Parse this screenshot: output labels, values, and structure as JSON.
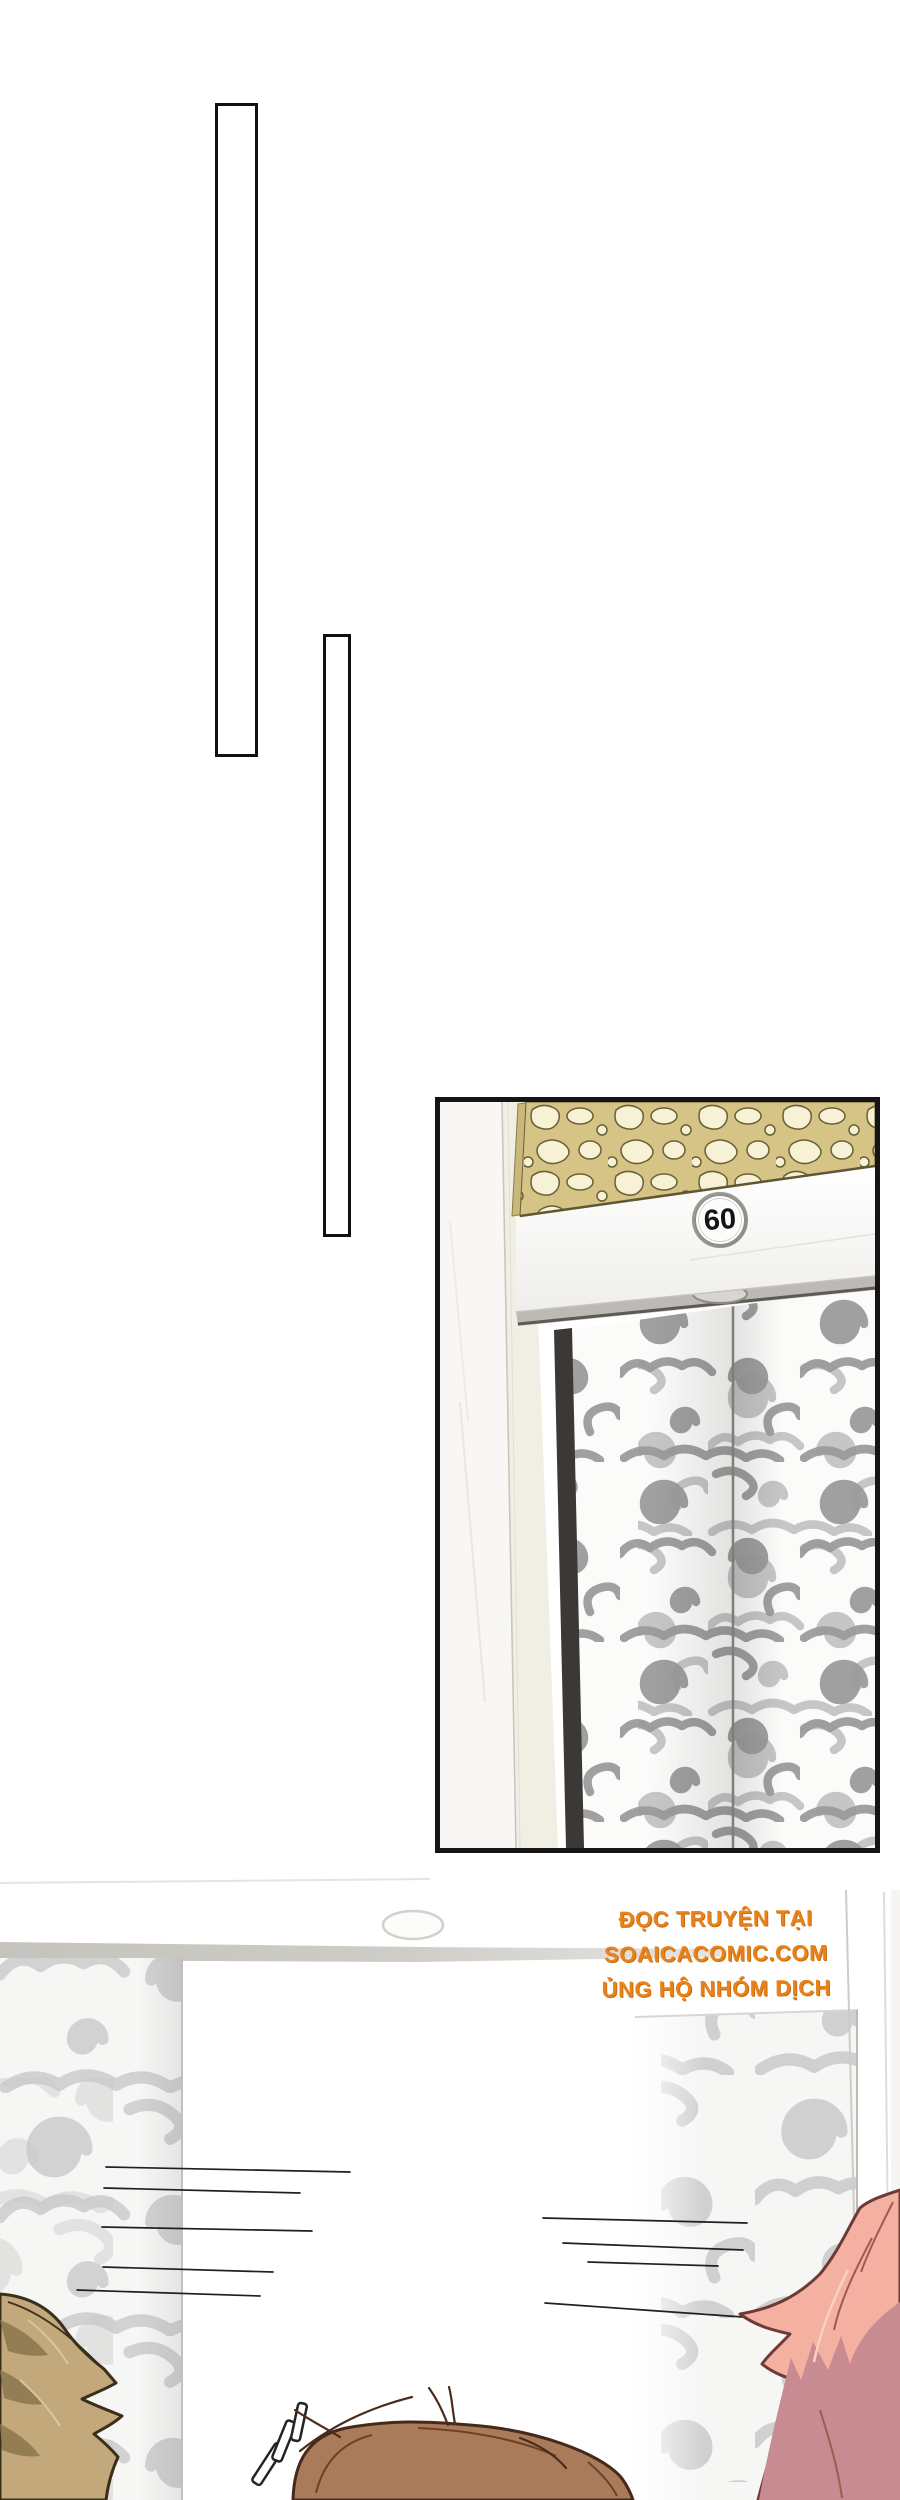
{
  "page": {
    "width": 900,
    "height": 2500,
    "background": "#ffffff",
    "kind": "comic-page"
  },
  "decor": {
    "bar_count": 2,
    "style": "thin outlined vertical rectangles"
  },
  "elevator_panel": {
    "floor_number": "60",
    "description": "framed panel: elevator entrance with golden openwork lattice transom, white header beam with round floor badge, gray cloud-swirl patterned doors"
  },
  "credits": {
    "line1": "ĐỌC TRUYỆN TẠI",
    "line2": "SOAICACOMIC.COM",
    "line3": "ỦNG HỘ NHÓM DỊCH",
    "color": "#e8821a"
  },
  "effects": {
    "exclamation_marks": "!!!",
    "speed_lines_left": 5,
    "speed_lines_right": 4
  },
  "colors": {
    "panel_border": "#151515",
    "lattice_gold": "#d6c486",
    "lattice_holes": "#f7f1d6",
    "lattice_outline": "#6a6036",
    "door_swirl_dark": "#9b9b9b",
    "door_swirl_light": "#c9c9c9",
    "beam_soffit": "#bdb9b4",
    "hair_left": "#c2a87a",
    "hair_left_shadow": "#8e7950",
    "hair_center": "#a97b5b",
    "hair_right_light": "#f4b0a0",
    "hair_right_shadow": "#c88b92"
  }
}
